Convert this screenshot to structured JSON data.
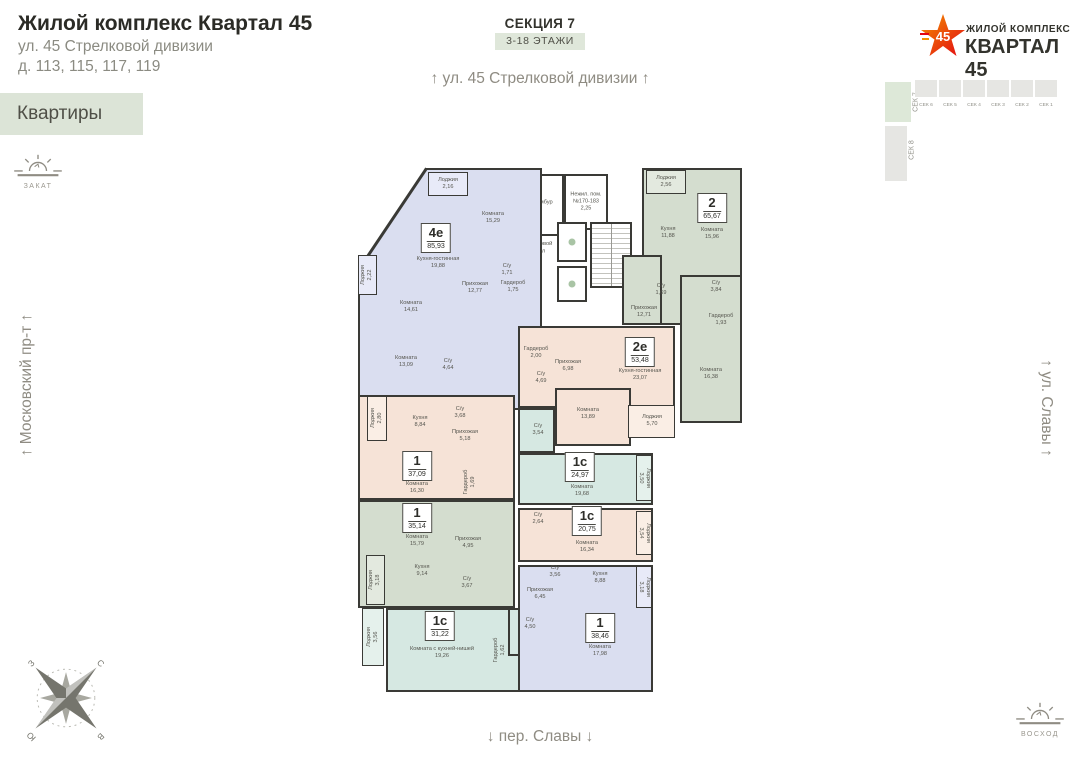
{
  "header": {
    "title": "Жилой комплекс Квартал 45",
    "address1": "ул. 45 Стрелковой дивизии",
    "address2": "д. 113, 115, 117, 119",
    "section_title": "СЕКЦИЯ 7",
    "floors_badge": "3-18 ЭТАЖИ"
  },
  "nav": {
    "apartments_button": "Квартиры"
  },
  "logo": {
    "line1": "ЖИЛОЙ КОМПЛЕКС",
    "line2": "КВАРТАЛ 45",
    "star": "45"
  },
  "streets": {
    "top": "↑ ул. 45 Стрелковой дивизии ↑",
    "bottom": "↓ пер. Славы ↓",
    "left": "↑ Московский пр-т ↑",
    "right": "↑ ул. Славы ↑"
  },
  "sun": {
    "sunset_label": "ЗАКАТ",
    "sunrise_label": "ВОСХОД"
  },
  "compass": {
    "north": "С",
    "east": "В",
    "south": "Ю",
    "west": "З"
  },
  "minimap": {
    "current": "СЕК 7",
    "vertical": "СЕК 8",
    "others": [
      "СЕК 6",
      "СЕК 5",
      "СЕК 4",
      "СЕК 3",
      "СЕК 2",
      "СЕК 1"
    ]
  },
  "core": {
    "tambur": "Тамбур",
    "nonres_name": "Нежил. пом. №170-183",
    "nonres_area": "2,25",
    "lift_hall": "Лифтовой холл"
  },
  "colors": {
    "lavender": "#dadef0",
    "green": "#d4ddcf",
    "peach": "#f6e3d7",
    "teal": "#d6e8e2",
    "lavender_light": "#e8eaf8",
    "green_light": "#e3e9df",
    "peach_light": "#faeee5",
    "teal_light": "#e5f1ec",
    "wall": "#3a3a36",
    "accent_bg": "#dfe7da",
    "logo_red": "#e03018"
  },
  "apartments": [
    {
      "id": "4e",
      "label": "4е",
      "area": "85,93",
      "color": "lavender",
      "rooms": [
        {
          "name": "Лоджия",
          "area": "2,16"
        },
        {
          "name": "Комната",
          "area": "15,29"
        },
        {
          "name": "Кухня-гостинная",
          "area": "19,88"
        },
        {
          "name": "Лоджия",
          "area": "2,22"
        },
        {
          "name": "Прихожая",
          "area": "12,77"
        },
        {
          "name": "С/у",
          "area": "1,71"
        },
        {
          "name": "Гардероб",
          "area": "1,75"
        },
        {
          "name": "Комната",
          "area": "14,61"
        },
        {
          "name": "Комната",
          "area": "13,09"
        },
        {
          "name": "С/у",
          "area": "4,64"
        }
      ]
    },
    {
      "id": "2",
      "label": "2",
      "area": "65,67",
      "color": "green",
      "rooms": [
        {
          "name": "Лоджия",
          "area": "2,56"
        },
        {
          "name": "Кухня",
          "area": "11,88"
        },
        {
          "name": "Комната",
          "area": "15,96"
        },
        {
          "name": "С/у",
          "area": "1,69"
        },
        {
          "name": "С/у",
          "area": "3,84"
        },
        {
          "name": "Прихожая",
          "area": "12,71"
        },
        {
          "name": "Гардероб",
          "area": "1,93"
        },
        {
          "name": "Комната",
          "area": "16,38"
        }
      ]
    },
    {
      "id": "2e",
      "label": "2е",
      "area": "53,48",
      "color": "peach",
      "rooms": [
        {
          "name": "Гардероб",
          "area": "2,00"
        },
        {
          "name": "Прихожая",
          "area": "6,98"
        },
        {
          "name": "С/у",
          "area": "4,69"
        },
        {
          "name": "Кухня-гостинная",
          "area": "23,07"
        },
        {
          "name": "Комната",
          "area": "13,89"
        },
        {
          "name": "Лоджия",
          "area": "5,70"
        }
      ]
    },
    {
      "id": "1-37",
      "label": "1",
      "area": "37,09",
      "color": "peach",
      "rooms": [
        {
          "name": "Лоджия",
          "area": "2,80"
        },
        {
          "name": "Кухня",
          "area": "8,84"
        },
        {
          "name": "С/у",
          "area": "3,68"
        },
        {
          "name": "Прихожая",
          "area": "5,18"
        },
        {
          "name": "Комната",
          "area": "16,30"
        },
        {
          "name": "Гардероб",
          "area": "1,69"
        }
      ]
    },
    {
      "id": "1-35",
      "label": "1",
      "area": "35,14",
      "color": "green",
      "rooms": [
        {
          "name": "Комната",
          "area": "15,79"
        },
        {
          "name": "Прихожая",
          "area": "4,95"
        },
        {
          "name": "Кухня",
          "area": "9,14"
        },
        {
          "name": "С/у",
          "area": "3,67"
        },
        {
          "name": "Лоджия",
          "area": "3,18"
        }
      ]
    },
    {
      "id": "1c-31",
      "label": "1с",
      "area": "31,22",
      "color": "teal",
      "rooms": [
        {
          "name": "Лоджия",
          "area": "3,56"
        },
        {
          "name": "Комната с кухней-нишей",
          "area": "19,26"
        },
        {
          "name": "С/у",
          "area": "4,50"
        },
        {
          "name": "Гардероб",
          "area": "1,62"
        }
      ]
    },
    {
      "id": "1c-24",
      "label": "1с",
      "area": "24,97",
      "color": "teal",
      "rooms": [
        {
          "name": "С/у",
          "area": "3,54"
        },
        {
          "name": "Комната",
          "area": "19,68"
        },
        {
          "name": "Лоджия",
          "area": "3,50"
        }
      ]
    },
    {
      "id": "1c-20",
      "label": "1с",
      "area": "20,75",
      "color": "peach",
      "rooms": [
        {
          "name": "С/у",
          "area": "2,64"
        },
        {
          "name": "Комната",
          "area": "16,34"
        },
        {
          "name": "Лоджия",
          "area": "3,54"
        }
      ]
    },
    {
      "id": "1-38",
      "label": "1",
      "area": "38,46",
      "color": "lavender",
      "rooms": [
        {
          "name": "С/у",
          "area": "3,56"
        },
        {
          "name": "Кухня",
          "area": "8,88"
        },
        {
          "name": "Прихожая",
          "area": "6,45"
        },
        {
          "name": "Комната",
          "area": "17,98"
        },
        {
          "name": "Лоджия",
          "area": "3,18"
        }
      ]
    }
  ]
}
